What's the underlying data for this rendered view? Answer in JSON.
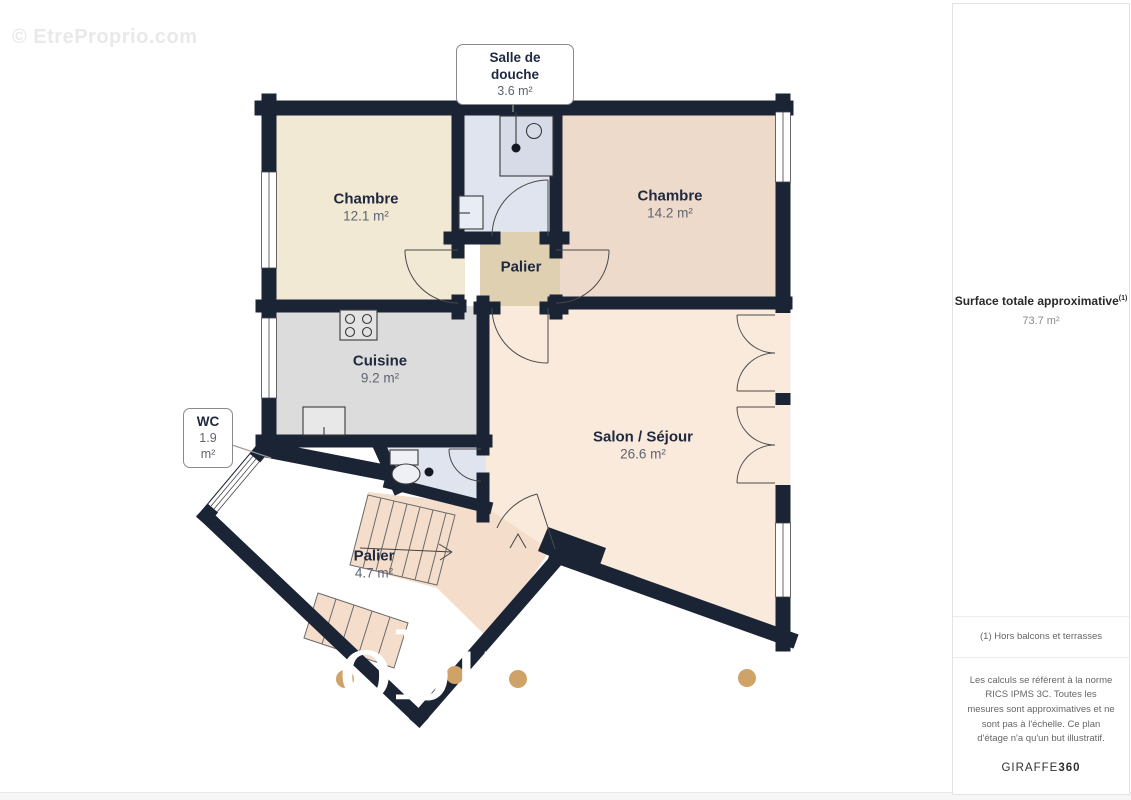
{
  "watermarks": {
    "copyright": "© EtreProprio.com",
    "overlay_fragment": "obu"
  },
  "plan": {
    "rooms": [
      {
        "id": "chambre-1",
        "name": "Chambre",
        "area": "12.1 m²"
      },
      {
        "id": "chambre-2",
        "name": "Chambre",
        "area": "14.2 m²"
      },
      {
        "id": "cuisine",
        "name": "Cuisine",
        "area": "9.2 m²"
      },
      {
        "id": "palier-centre",
        "name": "Palier",
        "area": ""
      },
      {
        "id": "salon-sejour",
        "name": "Salon / Séjour",
        "area": "26.6 m²"
      },
      {
        "id": "palier-bas",
        "name": "Palier",
        "area": "4.7 m²"
      }
    ],
    "callouts": [
      {
        "id": "salle-de-douche",
        "name": "Salle de douche",
        "area": "3.6 m²"
      },
      {
        "id": "wc",
        "name": "WC",
        "area": "1.9 m²"
      }
    ],
    "icons": [
      "stove-icon",
      "sink-icon",
      "shower-icon",
      "toilet-icon",
      "door-arc-icon",
      "window-icon",
      "stairs-icon"
    ]
  },
  "sidebar": {
    "surface_label": "Surface totale approximative",
    "surface_sup": "(1)",
    "surface_value": "73.7 m²",
    "note": "(1) Hors balcons et terrasses",
    "disclaimer": "Les calculs se réfèrent à la norme RICS IPMS 3C. Toutes les mesures sont approximatives et ne sont pas à l'échelle. Ce plan d'étage n'a qu'un but illustratif.",
    "brand_name": "GIRAFFE",
    "brand_suffix": "360"
  },
  "colors": {
    "wall": "#1b2435",
    "floor_chambre_1": "#f2e9d4",
    "floor_chambre_2": "#eedacb",
    "floor_salon": "#faeadc",
    "floor_stairs": "#f4ddcb",
    "floor_cuisine": "#dcdcdc",
    "floor_wet_room": "#e0e4ee",
    "floor_palier": "#ded0b0",
    "watermark_dot": "#cfa367",
    "label_dark": "#1e2940",
    "label_gray": "#5f6470"
  }
}
